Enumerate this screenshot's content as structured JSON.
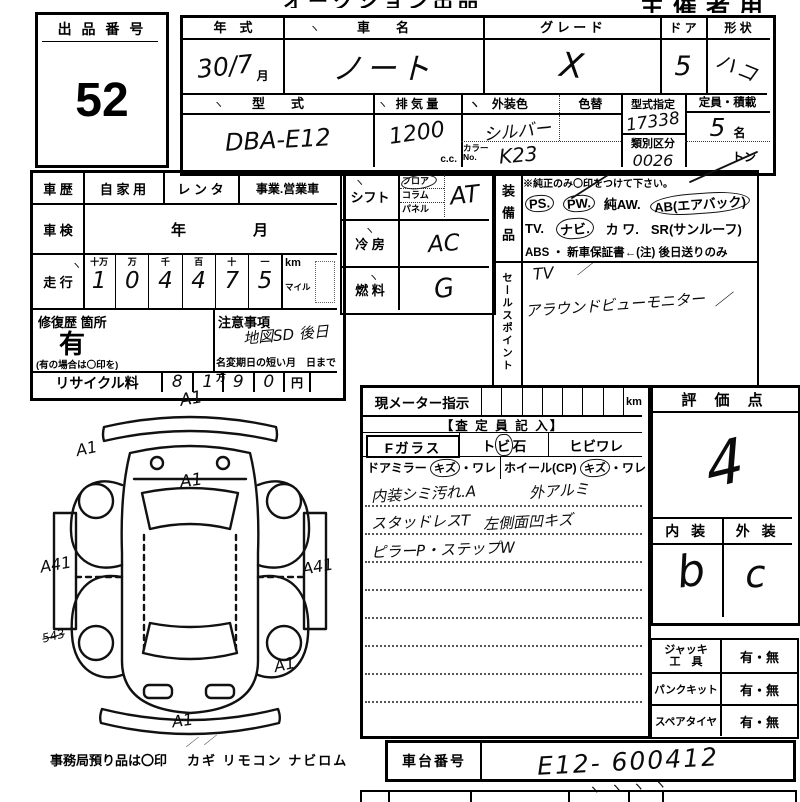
{
  "header": {
    "title_cropped": "オークション出品票",
    "organizer": "主催者用"
  },
  "marks": {
    "tick": "ヽ",
    "slash": "／"
  },
  "lot": {
    "label": "出 品 番 号",
    "value": "52"
  },
  "vehicle": {
    "year": {
      "label": "年　式",
      "value": "30/7",
      "suffix": "月"
    },
    "name": {
      "label": "車　　名",
      "value": "ノート"
    },
    "grade": {
      "label": "グ レ ー ド",
      "value": "X"
    },
    "door": {
      "label": "ド ア",
      "value": "5"
    },
    "shape": {
      "label": "形 状",
      "value": "ハコ"
    },
    "model": {
      "label": "型　　式",
      "value": "DBA-E12"
    },
    "displacement": {
      "label": "排 気 量",
      "value": "1200",
      "suffix": "c.c."
    },
    "ext_color": {
      "label": "外装色",
      "value": "シルバー"
    },
    "color_change": {
      "label": "色替"
    },
    "color_no": {
      "label": "カラーNo.",
      "value": "K23"
    },
    "type_designation": {
      "label": "型式指定",
      "value": "17338"
    },
    "classification": {
      "label": "類別区分",
      "value": "0026"
    },
    "capacity": {
      "label": "定員・積載",
      "value": "5",
      "suffix": "名",
      "ton": "トン"
    }
  },
  "history": {
    "label": "車 歴",
    "opt1": "自 家 用",
    "opt2": "レ ン タ",
    "opt3": "事業.営業車"
  },
  "inspection": {
    "label": "車 検",
    "year": "年",
    "month": "月"
  },
  "mileage": {
    "label": "走 行",
    "headers": [
      "十万",
      "万",
      "千",
      "百",
      "十",
      "一"
    ],
    "digits": [
      "1",
      "0",
      "4",
      "4",
      "7",
      "5"
    ],
    "km": "km",
    "mile": "マイル"
  },
  "repair": {
    "label": "修復歴 箇所",
    "value": "有",
    "note": "(有の場合は〇印を)"
  },
  "caution": {
    "label": "注意事項",
    "value": "地図SD 後日",
    "rename": "名変期日の短い方",
    "until": "月　日まで"
  },
  "recycle": {
    "label": "リサイクル料",
    "digits": [
      "8",
      "1",
      "9",
      "0"
    ],
    "yen": "円"
  },
  "shift": {
    "label": "シフト",
    "opt1": "フロア",
    "opt2": "コラム",
    "opt3": "パネル",
    "value": "AT"
  },
  "aircon": {
    "label": "冷 房",
    "value": "AC"
  },
  "fuel": {
    "label": "燃 料",
    "value": "G"
  },
  "equipment": {
    "label": "装備品",
    "note": "※純正のみ〇印をつけて下さい。",
    "ps": "PS.",
    "pw": "PW.",
    "aw": "純AW.",
    "ab": "AB(エアバック)",
    "tv": "TV.",
    "navi": "ナビ.",
    "kawa": "カ ワ.",
    "sr": "SR(サンルーフ)",
    "line3": "ABS ・ 新車保証書←(注) 後日送りのみ"
  },
  "sales": {
    "label": "セールスポイント",
    "line1": "TV",
    "line2": "アラウンドビューモニター"
  },
  "meter": {
    "label": "現メーター指示",
    "unit": "km"
  },
  "assessor": {
    "header": "【査 定 員 記 入】",
    "fglass": "Fガラス",
    "tobi": "ト",
    "tobi_circled": "ビ",
    "tobi_rest": "石",
    "hibi": "ヒビワレ",
    "mirror": "ドアミラー",
    "mirror_kizu": "キズ",
    "mirror_ware": "・ワレ",
    "wheel": "ホイール(CP)",
    "wheel_kizu": "キズ",
    "wheel_ware": "・ワレ",
    "note1a": "内装シミ汚れ.A",
    "note1b": "外アルミ",
    "note2a": "スタッドレスT",
    "note2b": "左側面凹キズ",
    "note3": "ピラーP・ステップW"
  },
  "evaluation": {
    "label": "評 価 点",
    "score": "4",
    "interior_label": "内 装",
    "exterior_label": "外 装",
    "interior": "b",
    "exterior": "c"
  },
  "tools": {
    "rows": [
      {
        "label": "ジャッキ\n工　具",
        "value": "有・無"
      },
      {
        "label": "パンクキット",
        "value": "有・無"
      },
      {
        "label": "スペアタイヤ",
        "value": "有・無"
      }
    ]
  },
  "chassis": {
    "label": "車台番号",
    "value": "E12- 600412"
  },
  "footer": {
    "note": "事務局預り品は〇印",
    "items": "カギ  リモコン  ナビロム"
  },
  "diagram": {
    "annotations": [
      "A1",
      "A1",
      "A1",
      "A41",
      "A41",
      "543",
      "A1",
      "A1"
    ]
  }
}
